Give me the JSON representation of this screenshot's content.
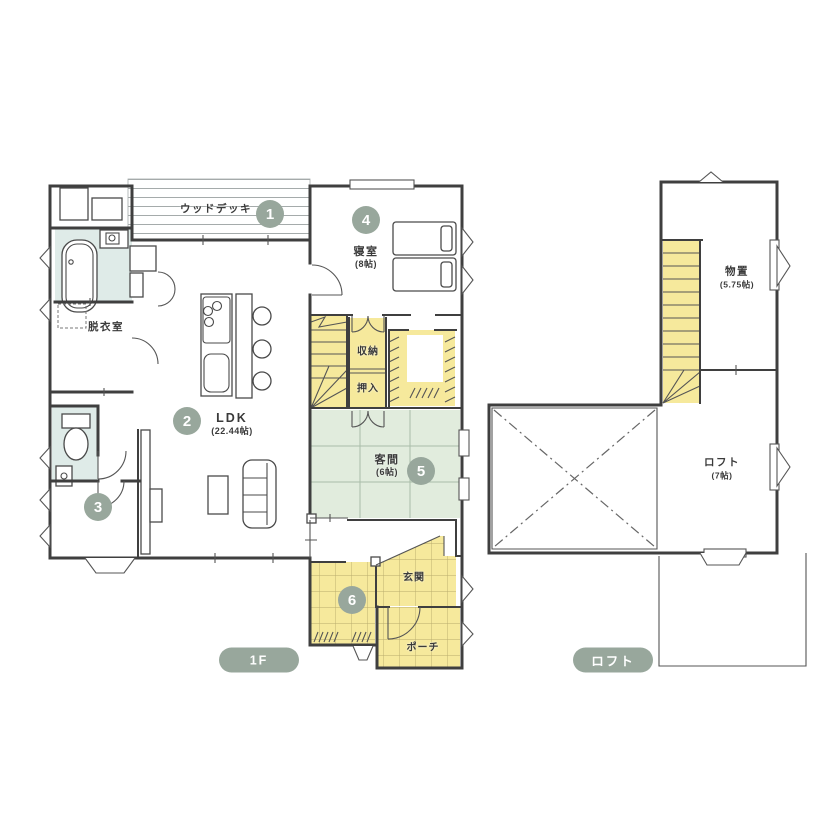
{
  "palette": {
    "accent": "#98a79c",
    "floor_yellow": "#f6e99c",
    "tatami_green": "#e1ecdd",
    "water_blue": "#dfebe8",
    "wall": "#3f3f3f"
  },
  "floor1": {
    "badge": "1F",
    "rooms": {
      "wood_deck": {
        "label": "ウッドデッキ",
        "marker": "1"
      },
      "ldk": {
        "label": "LDK",
        "size": "(22.44帖)",
        "marker": "2"
      },
      "free_room": {
        "marker": "3"
      },
      "bedroom": {
        "label": "寝室",
        "size": "(8帖)",
        "marker": "4"
      },
      "guest_room": {
        "label": "客間",
        "size": "(6帖)",
        "marker": "5"
      },
      "shoe_closet": {
        "marker": "6"
      },
      "dressing_room": {
        "label": "脱衣室"
      },
      "storage": {
        "label": "収納"
      },
      "futon_closet": {
        "label": "押入"
      },
      "entrance": {
        "label": "玄関"
      },
      "porch": {
        "label": "ポーチ"
      }
    }
  },
  "loft_floor": {
    "badge": "ロフト",
    "rooms": {
      "storeroom": {
        "label": "物置",
        "size": "(5.75帖)"
      },
      "loft": {
        "label": "ロフト",
        "size": "(7帖)"
      }
    }
  }
}
